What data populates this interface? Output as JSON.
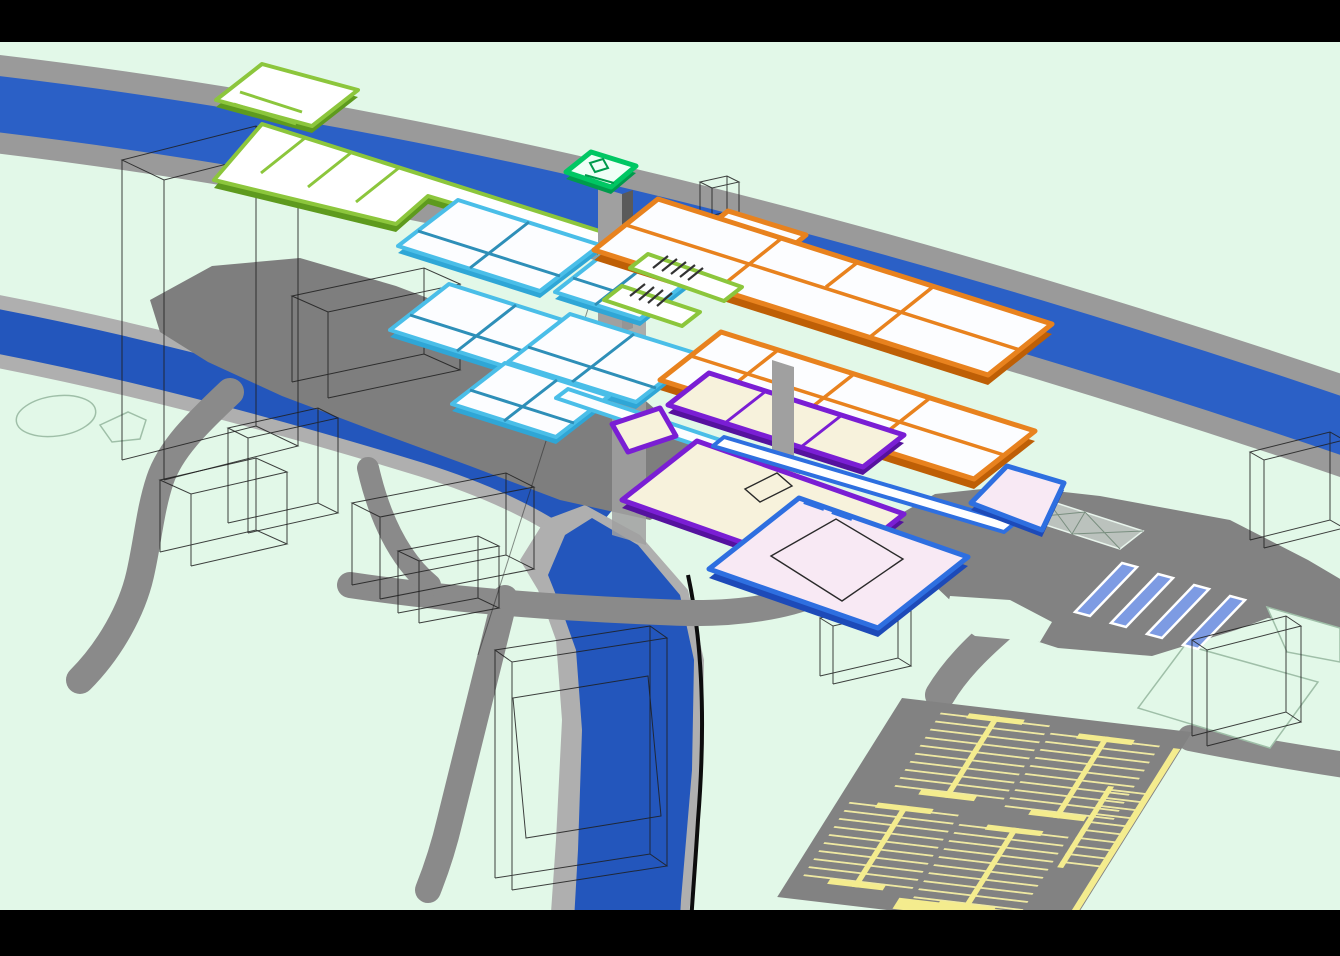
{
  "scene": {
    "title": "Axonometric site diagram of a multi-level building complex",
    "description": "Exploded axonometric architectural diagram: colour-coded floor plates (lime, emerald, cyan, orange, purple, blue) hover over a site crossed by a blue motorway band, a curving blue river, gray roads, a plaza with four blue bus-bay stripes, a parking lot with pale-yellow stall markings, and transparent wireframe context buildings on a pale mint ground. No text labels are present in the drawing.",
    "visible_text": ""
  },
  "palette": {
    "bg": "#E2F8E8",
    "bar": "#000000",
    "band_gray": "#9A9A9A",
    "band_blue": "#2B60C6",
    "river_bank": "#AFAFAF",
    "river_blue": "#2356BC",
    "river_edge": "#0D0D0D",
    "ground": "#7E7E7E",
    "plaza": "#828282",
    "road": "#8A8A8A",
    "outline_soft": "#9FBFA8",
    "mint_pad": "#E2F8E8",
    "lime": "#8CC63C",
    "lime_dark": "#5E9A1E",
    "emerald": "#00C763",
    "emerald_dark": "#009B4C",
    "cyan": "#4ABEE8",
    "cyan_dark": "#2E8FB8",
    "cyan_side": "#2FA6D6",
    "orange": "#E8821E",
    "orange_dark": "#BE5F06",
    "purple": "#7A1ED4",
    "purple_dark": "#55129E",
    "blue": "#2E6FE0",
    "blue_dark": "#1D4AB8",
    "pink": "#F8E9F4",
    "cream": "#F7F2DC",
    "floor": "#FCFDFF",
    "white": "#FFFFFF",
    "yellow": "#EFE9A2",
    "yellow_bright": "#F4EC8E",
    "periwinkle": "#7D9BE3",
    "shaft": "#A0A0A0",
    "wire": "#1F1F1F",
    "hatch": "#333333"
  },
  "floor_plate_groups": [
    {
      "name": "lime-green plates (roof, slab with long walkway, stair links)",
      "color_ref": "lime",
      "plate_count": 3,
      "floor_fill_ref": "white"
    },
    {
      "name": "emerald rooftop pavilion on core shaft",
      "color_ref": "emerald",
      "plate_count": 1
    },
    {
      "name": "cyan plates with teal room partitions and bridge walkway",
      "color_ref": "cyan",
      "plate_count": 5,
      "bridge_count": 1
    },
    {
      "name": "orange plate bands with room partitions",
      "color_ref": "orange",
      "plate_count": 2
    },
    {
      "name": "purple-edged cream plates",
      "color_ref": "purple",
      "plate_count": 2,
      "floor_fill_ref": "cream"
    },
    {
      "name": "blue-edged pink plates and corridor",
      "color_ref": "blue",
      "plate_count": 2,
      "corridor_count": 1,
      "floor_fill_ref": "pink"
    }
  ],
  "infrastructure": {
    "letterbox_bars": {
      "count": 2,
      "color_ref": "bar",
      "top_height_px": 42,
      "bottom_height_px": 46
    },
    "motorway_band": {
      "asphalt_ref": "band_gray",
      "water_ref": "band_blue",
      "runs": "upper-left to right edge"
    },
    "river": {
      "bank_ref": "river_bank",
      "water_ref": "river_blue",
      "east_bank_edge_ref": "river_edge",
      "course": "from left edge, bends south to bottom edge"
    },
    "roads": {
      "count": 6,
      "color_ref": "road"
    },
    "plaza": {
      "color_ref": "plaza",
      "crosswalk_stripes": {
        "count": 4,
        "fill_ref": "periwinkle",
        "outline": "#FFFFFF"
      },
      "canopy_outline_cells": 2
    },
    "parking_lot": {
      "color_ref": "plaza",
      "bays": 5,
      "stall_tick_color_ref": "yellow",
      "spine_color_ref": "yellow_bright",
      "edge_stripe": 1
    },
    "stair_hatches": {
      "count": 2,
      "color_ref": "hatch"
    },
    "core_shafts": {
      "count": 3,
      "color_ref": "shaft"
    },
    "wireframe_buildings": {
      "count": 11,
      "stroke_ref": "wire"
    },
    "pond_outline": {
      "ellipse_count": 1,
      "quad_count": 1,
      "stroke_ref": "outline_soft"
    }
  }
}
